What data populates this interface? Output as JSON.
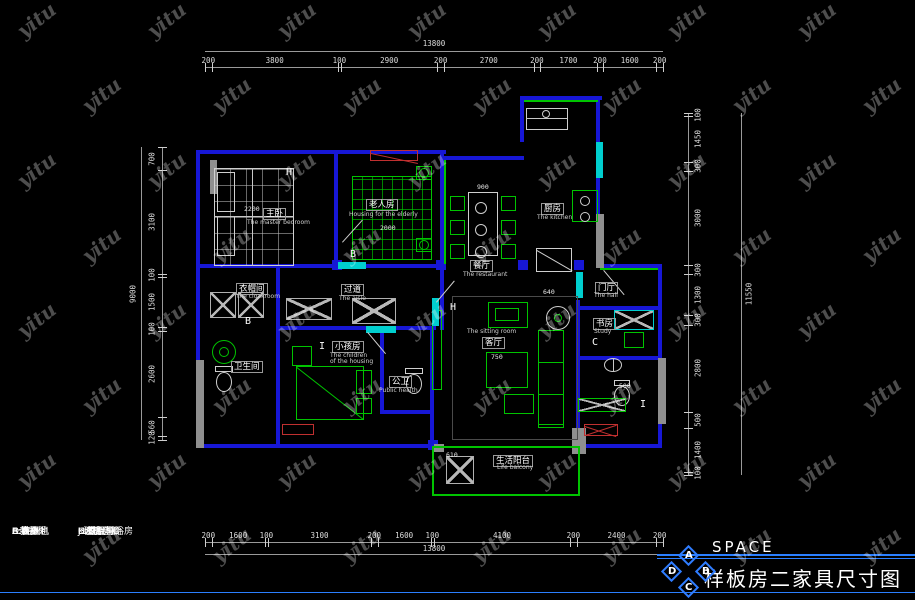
{
  "watermark": {
    "text": "yitu"
  },
  "brand_box": {
    "id": "id",
    "firm_cn": "室内设计师事务所",
    "firm_en": "INTERIOR DESIGNER FIRM"
  },
  "title_block": {
    "brand": "SPACE",
    "title": "样板房二家具尺寸图",
    "diamond": [
      "A",
      "D",
      "B",
      "C"
    ]
  },
  "legend": {
    "col1": [
      "A:鞋柜",
      "B:衣柜",
      "C:書桌",
      "D:洗衣机",
      "E:拖把池",
      "F:雜物柜"
    ],
    "col2": [
      "G:成品淋浴房",
      "H:電視柜",
      "I:書柜",
      "J:玻璃造形",
      "K:衣柜",
      "L:藝術隔斷"
    ]
  },
  "dims": {
    "top": {
      "total": "13800",
      "segments": [
        "200",
        "3800",
        "100",
        "2900",
        "200",
        "2700",
        "200",
        "1700",
        "200",
        "1600",
        "200"
      ]
    },
    "bottom": {
      "total": "13800",
      "segments": [
        "200",
        "1600",
        "100",
        "3100",
        "200",
        "1600",
        "100",
        "4100",
        "200",
        "2400",
        "200"
      ]
    },
    "left": {
      "total": "9000",
      "segments": [
        "700",
        "3100",
        "100",
        "1500",
        "100",
        "2600",
        "560",
        "120"
      ]
    },
    "right": {
      "total": "11550",
      "segments": [
        "100",
        "1450",
        "300",
        "3000",
        "300",
        "1300",
        "300",
        "2800",
        "500",
        "1400",
        "100"
      ]
    }
  },
  "rooms": [
    {
      "cn": "主卧",
      "en": "The master bedroom",
      "cx": 263,
      "cy": 208,
      "ex": 247,
      "ey": 220
    },
    {
      "cn": "老人房",
      "en": "Housing for the elderly",
      "cx": 366,
      "cy": 199,
      "ex": 349,
      "ey": 212
    },
    {
      "cn": "餐厅",
      "en": "The restaurant",
      "cx": 470,
      "cy": 260,
      "ex": 463,
      "ey": 272
    },
    {
      "cn": "厨房",
      "en": "The kitchen",
      "cx": 541,
      "cy": 203,
      "ex": 537,
      "ey": 215
    },
    {
      "cn": "过道",
      "en": "The aisle",
      "cx": 341,
      "cy": 284,
      "ex": 339,
      "ey": 296
    },
    {
      "cn": "衣帽间",
      "en": "the cloakroom",
      "cx": 236,
      "cy": 283,
      "ex": 237,
      "ey": 294
    },
    {
      "cn": "卫生间",
      "en": "",
      "cx": 231,
      "cy": 361,
      "ex": 0,
      "ey": 0
    },
    {
      "cn": "小孩房",
      "en": "The children",
      "en2": "of the housing",
      "cx": 332,
      "cy": 341,
      "ex": 330,
      "ey": 353,
      "e2x": 330,
      "e2y": 359
    },
    {
      "cn": "公卫",
      "en": "Public health",
      "cx": 389,
      "cy": 376,
      "ex": 379,
      "ey": 388
    },
    {
      "cn": "客厅",
      "en": "The sitting room",
      "cx": 482,
      "cy": 337,
      "ex": 467,
      "ey": 329
    },
    {
      "cn": "书房",
      "en": "Study",
      "cx": 593,
      "cy": 318,
      "ex": 594,
      "ey": 329
    },
    {
      "cn": "门厅",
      "en": "The hall",
      "cx": 595,
      "cy": 282,
      "ex": 594,
      "ey": 293
    },
    {
      "cn": "生活阳台",
      "en": "Life balcony",
      "cx": 493,
      "cy": 455,
      "ex": 497,
      "ey": 465
    }
  ],
  "letters": [
    {
      "t": "H",
      "x": 286,
      "y": 167
    },
    {
      "t": "B",
      "x": 350,
      "y": 249
    },
    {
      "t": "B",
      "x": 245,
      "y": 316
    },
    {
      "t": "I",
      "x": 319,
      "y": 341
    },
    {
      "t": "H",
      "x": 450,
      "y": 302
    },
    {
      "t": "C",
      "x": 592,
      "y": 337
    },
    {
      "t": "I",
      "x": 640,
      "y": 399
    }
  ],
  "inner_dims": [
    {
      "t": "2200",
      "x": 244,
      "y": 205
    },
    {
      "t": "2000",
      "x": 380,
      "y": 224
    },
    {
      "t": "900",
      "x": 477,
      "y": 183
    },
    {
      "t": "640",
      "x": 543,
      "y": 288
    },
    {
      "t": "750",
      "x": 491,
      "y": 353
    },
    {
      "t": "610",
      "x": 446,
      "y": 451
    },
    {
      "t": "500",
      "x": 619,
      "y": 382
    }
  ]
}
